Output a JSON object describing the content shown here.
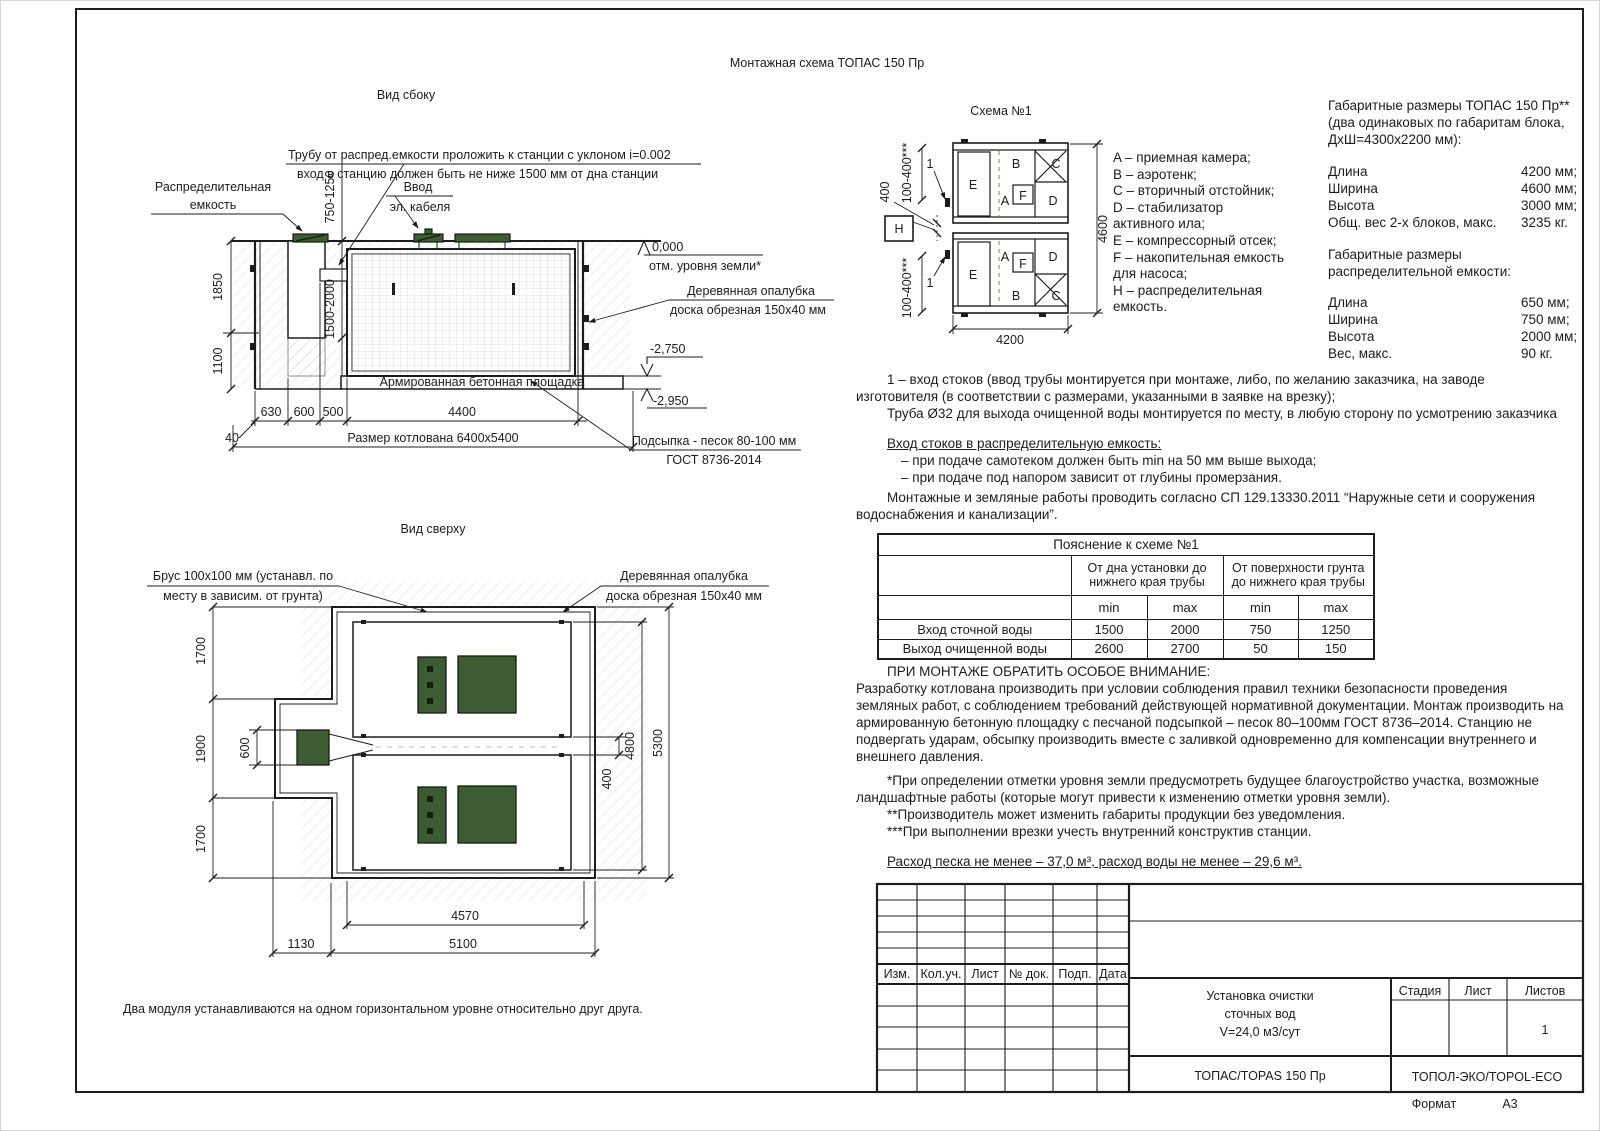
{
  "page": {
    "title": "Монтажная схема ТОПАС 150 Пр",
    "format_label": "Формат",
    "format_value": "А3"
  },
  "side_view": {
    "title": "Вид сбоку",
    "pipe_note1": "Трубу от распред.емкости проложить к станции с уклоном i=0.002",
    "pipe_note2": "вход в станцию должен быть не ниже 1500 мм от дна станции",
    "dist_tank1": "Распределительная",
    "dist_tank2": "емкость",
    "cable1": "Ввод",
    "cable2": "эл. кабеля",
    "dim_inlet": "750-1250",
    "dim_1850": "1850",
    "dim_1100": "1100",
    "dim_tank": "1500-2000",
    "concrete_pad": "Армированная бетонная площадка",
    "level_zero": "0,000",
    "level_zero_note": "отм. уровня земли*",
    "formwork1": "Деревянная опалубка",
    "formwork2": "доска обрезная 150х40 мм",
    "level_2750": "-2,750",
    "level_2950": "-2,950",
    "sand1": "Подсыпка - песок 80-100 мм",
    "sand2": "ГОСТ 8736-2014",
    "dim_40": "40",
    "dim_630": "630",
    "dim_600": "600",
    "dim_500": "500",
    "dim_4400": "4400",
    "pit_size": "Размер котлована 6400х5400"
  },
  "top_view": {
    "title": "Вид сверху",
    "beam1": "Брус 100х100 мм (устанавл. по",
    "beam2": "месту в зависим. от грунта)",
    "formwork1": "Деревянная опалубка",
    "formwork2": "доска обрезная 150х40 мм",
    "dim_1700a": "1700",
    "dim_1900": "1900",
    "dim_600": "600",
    "dim_1700b": "1700",
    "dim_400": "400",
    "dim_4800": "4800",
    "dim_5300": "5300",
    "dim_4570": "4570",
    "dim_5100": "5100",
    "dim_1130": "1130",
    "note": "Два модуля устанавливаются на одном горизонтальном уровне относительно друг друга."
  },
  "schema": {
    "title": "Схема №1",
    "comp_a1": "A",
    "comp_b1": "B",
    "comp_c1": "C",
    "comp_d1": "D",
    "comp_e1": "E",
    "comp_f1": "F",
    "comp_a2": "A",
    "comp_b2": "B",
    "comp_c2": "C",
    "comp_d2": "D",
    "comp_e2": "E",
    "comp_f2": "F",
    "comp_h": "H",
    "callout1": "1",
    "callout2": "1",
    "dim_400": "400",
    "dim_100_400a": "100-400***",
    "dim_100_400b": "100-400***",
    "dim_4600": "4600",
    "dim_4200": "4200"
  },
  "legend": {
    "lines": [
      "A – приемная камера;",
      "B – аэротенк;",
      "C – вторичный отстойник;",
      "D – стабилизатор",
      "активного ила;",
      "E – компрессорный отсек;",
      "F – накопительная емкость",
      "для насоса;",
      "H – распределительная",
      "емкость."
    ]
  },
  "overall_dims": {
    "title1": "Габаритные размеры ТОПАС 150 Пр**",
    "title2": "(два одинаковых по габаритам блока,",
    "title3": "ДхШ=4300х2200 мм):",
    "rows": [
      {
        "label": "Длина",
        "value": "4200 мм;"
      },
      {
        "label": "Ширина",
        "value": "4600 мм;"
      },
      {
        "label": "Высота",
        "value": "3000 мм;"
      },
      {
        "label": "Общ. вес 2-х блоков, макс.",
        "value": "3235 кг."
      }
    ],
    "subtitle1": "Габаритные размеры",
    "subtitle2": "распределительной емкости:",
    "rows2": [
      {
        "label": "Длина",
        "value": "650 мм;"
      },
      {
        "label": "Ширина",
        "value": "750 мм;"
      },
      {
        "label": "Высота",
        "value": "2000 мм;"
      },
      {
        "label": "Вес, макс.",
        "value": "90 кг."
      }
    ]
  },
  "notes": {
    "inlet1": "1 – вход  стоков (ввод трубы монтируется при монтаже, либо, по желанию заказчика, на заводе",
    "inlet2": "изготовителя (в соответствии с размерами, указанными в заявке на врезку);",
    "outlet": "Труба Ø32 для выхода очищенной воды монтируется по месту, в любую сторону по усмотрению заказчика",
    "dist_header": "Вход стоков в распределительную емкость:",
    "dist_b1": "– при подаче самотеком должен быть min на 50 мм выше выхода;",
    "dist_b2": "– при подаче под напором зависит от глубины промерзания.",
    "sp1": "Монтажные и земляные работы проводить согласно СП 129.13330.2011 “Наружные сети и сооружения",
    "sp2": "водоснабжения и канализации”."
  },
  "exp_table": {
    "title": "Пояснение к схеме №1",
    "group1": "От дна установки до нижнего края трубы",
    "group2": "От поверхности грунта до нижнего края трубы",
    "min1": "min",
    "max1": "max",
    "min2": "min",
    "max2": "max",
    "rows": [
      {
        "label": "Вход сточной воды",
        "c1": "1500",
        "c2": "2000",
        "c3": "750",
        "c4": "1250"
      },
      {
        "label": "Выход очищенной воды",
        "c1": "2600",
        "c2": "2700",
        "c3": "50",
        "c4": "150"
      }
    ]
  },
  "attention": {
    "title": "ПРИ МОНТАЖЕ ОБРАТИТЬ ОСОБОЕ ВНИМАНИЕ:",
    "lines": [
      "Разработку котлована производить при условии соблюдения правил техники безопасности проведения",
      "земляных работ, с соблюдением требований действующей нормативной документации.  Монтаж производить на",
      "армированную бетонную площадку с песчаной подсыпкой – песок 80–100мм ГОСТ 8736–2014. Станцию не",
      "подвергать ударам, обсыпку производить вместе с заливкой одновременно для компенсации внутреннего и",
      "внешнего давления."
    ]
  },
  "footnotes": {
    "f1a": "*При определении отметки уровня земли предусмотреть будущее благоустройство участка, возможные",
    "f1b": "ландшафтные работы (которые могут привести к изменению отметки уровня земли).",
    "f2": "**Производитель может изменить габариты продукции без уведомления.",
    "f3": "***При выполнении врезки учесть внутренний конструктив станции.",
    "consumption": "Расход песка не менее – 37,0 м³, расход воды не менее – 29,6 м³."
  },
  "title_block": {
    "col_izm": "Изм.",
    "col_kol": "Кол.уч.",
    "col_list": "Лист",
    "col_doc": "№ док.",
    "col_podp": "Подп.",
    "col_data": "Дата",
    "doc1": "Установка очистки",
    "doc2": "сточных вод",
    "doc3": "V=24,0 м3/сут",
    "stage": "Стадия",
    "sheet": "Лист",
    "sheets": "Листов",
    "sheets_value": "1",
    "product": "ТОПАС/TOPAS 150 Пр",
    "company": "ТОПОЛ-ЭКО/TOPOL-ECO"
  },
  "colors": {
    "line": "#1c1c1c",
    "lid_green": "#3d5c33",
    "hatch_gray": "#d9d9d9"
  }
}
